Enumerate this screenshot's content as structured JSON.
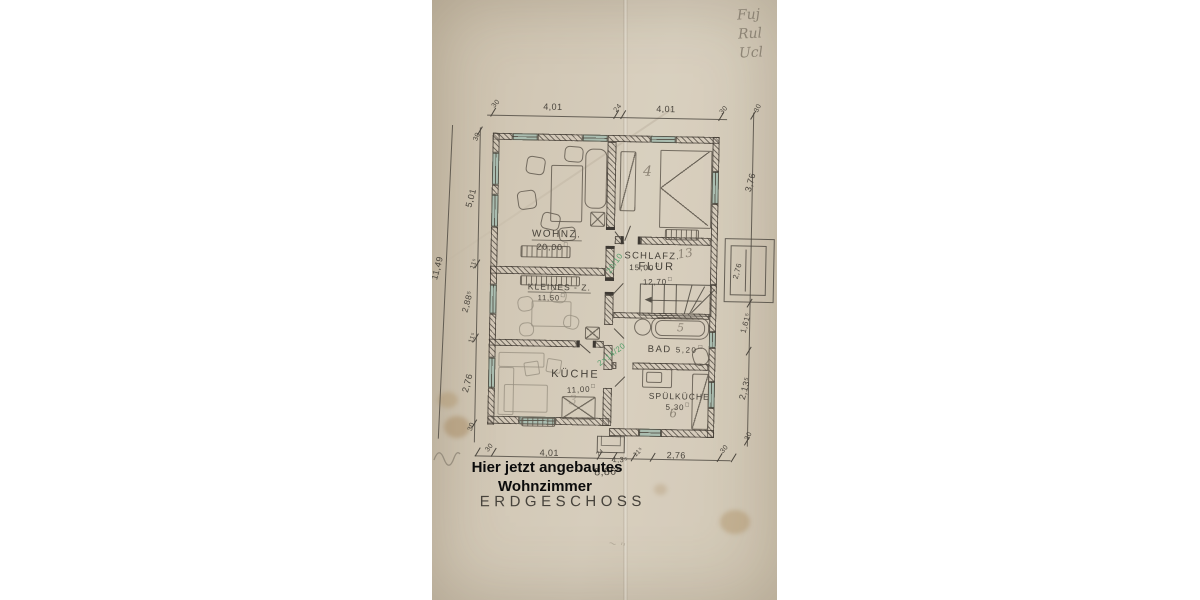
{
  "document": {
    "pencil_corner_note": [
      "Fuj",
      "Rul",
      "Ucl"
    ],
    "floor_label": "ERDGESCHOSS",
    "overlay": {
      "line1": "Hier jetzt angebautes",
      "line2": "Wohnzimmer"
    },
    "area_unit": "□",
    "rooms": {
      "wohnzimmer": {
        "name": "WOHNZ.",
        "area": "20,00"
      },
      "schlafzimmer": {
        "name": "SCHLAFZ.",
        "area": "15,00"
      },
      "flur": {
        "name": "FLUR",
        "area": "12,70"
      },
      "kleines_zimmer": {
        "name": "KLEINES - Z.",
        "area": "11,50"
      },
      "kueche": {
        "name": "KÜCHE",
        "area": "11,00"
      },
      "bad": {
        "name": "BAD",
        "area": "5,20"
      },
      "spuelkueche": {
        "name": "SPÜLKÜCHE",
        "area": "5,30"
      }
    },
    "dims": {
      "top": {
        "t1": "30",
        "d1": "4,01",
        "t2": "24",
        "d2": "4,01",
        "t3": "30"
      },
      "left_total": "11,49",
      "left": {
        "t1": "30",
        "d1": "5,01",
        "t2": "11⁵",
        "d2": "2,88⁵",
        "t3": "11⁵",
        "d3": "2,76",
        "t4": "30"
      },
      "right": {
        "t1": "30",
        "d1": "3,76",
        "box": "2,76",
        "d2": "1,61⁵",
        "d3": "2,13⁵",
        "t2": "30"
      },
      "bottom": {
        "t1": "30",
        "d1": "4,01",
        "c1": "2⁴",
        "c2": "1,3⁵",
        "c3": "11⁵",
        "d2": "2,76",
        "t2": "30",
        "total": "8,86⁵"
      }
    },
    "pencil_marks": {
      "schlafzimmer": "4",
      "flur": "13",
      "bad": "5",
      "spuelkueche": "6",
      "kueche": "3"
    },
    "green_notes": {
      "door": "20/10",
      "mid": "2×14/20"
    }
  }
}
